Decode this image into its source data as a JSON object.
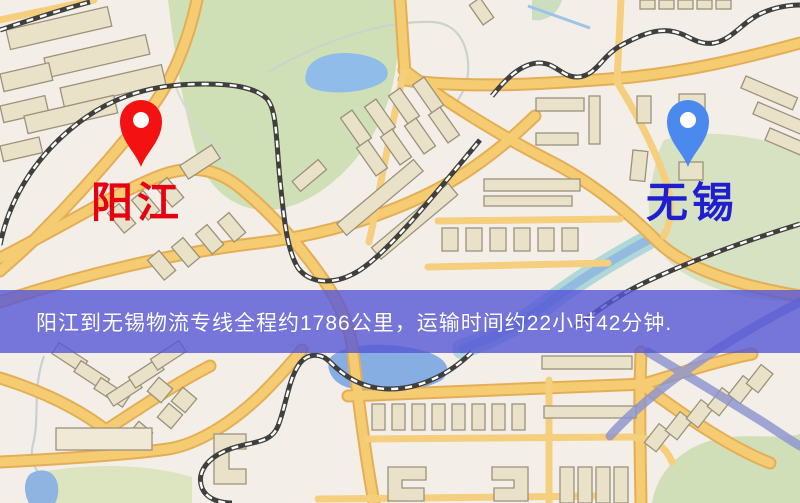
{
  "banner": {
    "text": "阳江到无锡物流专线全程约1786公里，运输时间约22小时42分钟.",
    "background": "#5656d6",
    "text_color": "#ffffff"
  },
  "markers": {
    "origin": {
      "label": "阳江",
      "pin_color": "#f31111",
      "label_color": "#e60012"
    },
    "destination": {
      "label": "无锡",
      "pin_color": "#4c89ee",
      "label_color": "#1f1fd0"
    }
  },
  "route_info": {
    "distance_text": "约1786公里",
    "duration_text": "约22小时42分钟"
  },
  "map_palette": {
    "background": "#f3efe8",
    "road_fill": "#f6cc72",
    "road_casing": "#e3ae56",
    "park": "#cfe0b6",
    "water": "#8fbce8",
    "building": "#eae2c8",
    "railway": "#3f3f3d"
  }
}
